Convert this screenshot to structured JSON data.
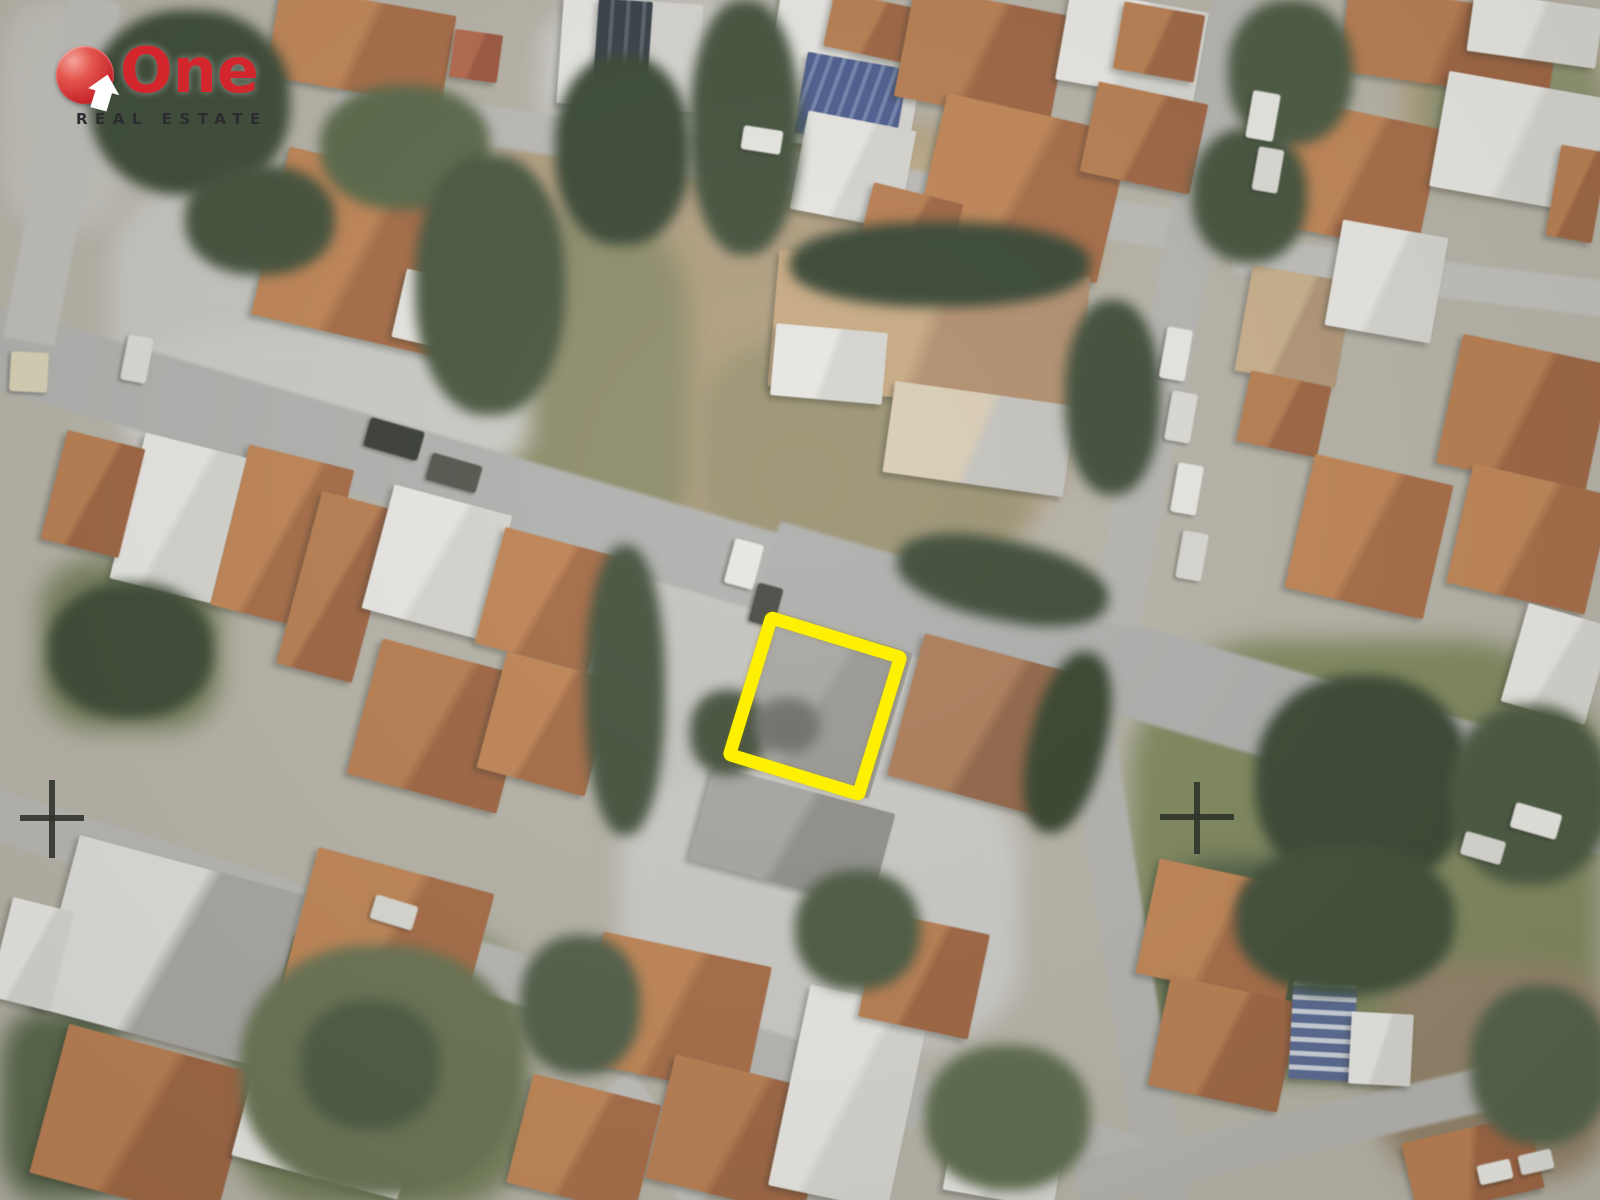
{
  "logo": {
    "brand": "One",
    "tagline": "REAL ESTATE",
    "brand_color": "#d2262c",
    "tagline_color": "#2b2b30",
    "badge_color": "#c6242b"
  },
  "annotations": {
    "property_outline_color": "#fdf000",
    "marker_symbol": "+",
    "marker_color": "#30342b",
    "marker_count": 2
  }
}
